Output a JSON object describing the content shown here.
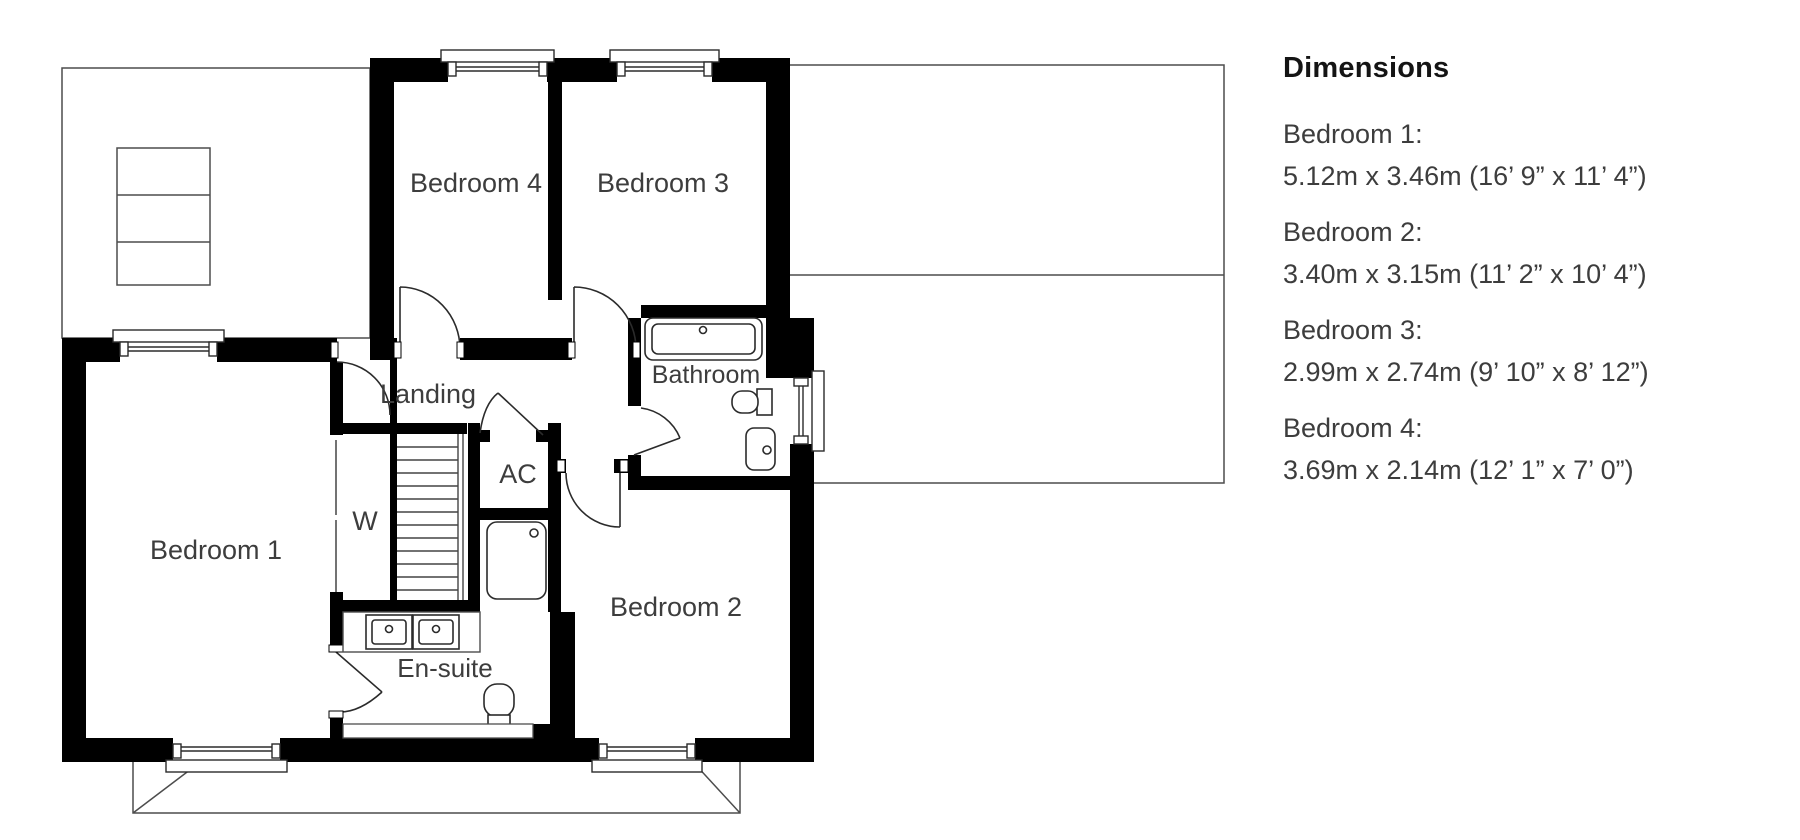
{
  "plan": {
    "rooms": {
      "bedroom1": "Bedroom 1",
      "bedroom2": "Bedroom 2",
      "bedroom3": "Bedroom 3",
      "bedroom4": "Bedroom 4",
      "landing": "Landing",
      "bathroom": "Bathroom",
      "ensuite": "En-suite",
      "ac": "AC",
      "wardrobe": "W"
    }
  },
  "dimensions_panel": {
    "title": "Dimensions",
    "entries": [
      {
        "label": "Bedroom 1:",
        "value": "5.12m x 3.46m (16’ 9” x 11’ 4”)"
      },
      {
        "label": "Bedroom 2:",
        "value": "3.40m x 3.15m (11’ 2” x 10’ 4”)"
      },
      {
        "label": "Bedroom 3:",
        "value": "2.99m x 2.74m (9’ 10” x 8’ 12”)"
      },
      {
        "label": "Bedroom 4:",
        "value": "3.69m x 2.14m (12’ 1” x 7’ 0”)"
      }
    ]
  },
  "colors": {
    "wall": "#000000",
    "thin_line": "#4d4d4d",
    "fixture_line": "#2b2b2b",
    "label_text": "#3d3d3d",
    "title_text": "#141414",
    "background": "#ffffff"
  }
}
